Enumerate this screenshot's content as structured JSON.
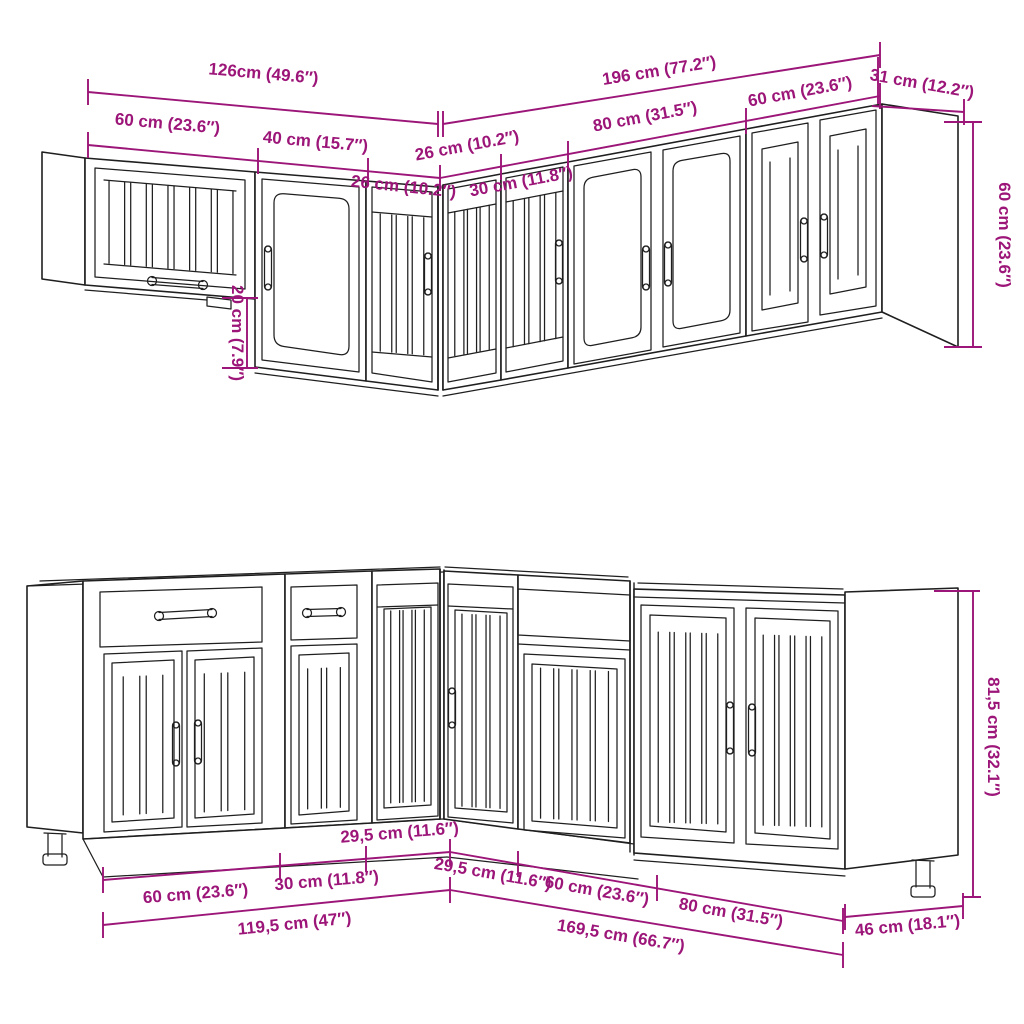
{
  "figure": {
    "kind": "furniture-dimension-line-art",
    "rows": [
      "wall-cabinets",
      "base-cabinets"
    ]
  },
  "colors": {
    "dimension": "#9C1578",
    "artwork": "#1F1F1F",
    "background": "#FFFFFF"
  },
  "labels": {
    "top_total_left": "126cm (49.6″)",
    "top_total_right": "196 cm (77.2″)",
    "top_depth_right": "31 cm (12.2″)",
    "top_seg_60_left": "60 cm (23.6″)",
    "top_seg_40": "40 cm (15.7″)",
    "top_seg_26_left": "26 cm (10.2″)",
    "top_seg_26_right": "26 cm (10.2″)",
    "top_seg_30": "30 cm (11.8″)",
    "top_seg_80": "80 cm (31.5″)",
    "top_seg_60_right": "60 cm (23.6″)",
    "top_height_offset": "20 cm (7.9″)",
    "top_height_right": "60 cm (23.6″)",
    "bottom_seg_29_left": "29,5 cm (11.6″)",
    "bottom_seg_60_left": "60 cm (23.6″)",
    "bottom_seg_30": "30 cm (11.8″)",
    "bottom_seg_29_right": "29,5 cm (11.6″)",
    "bottom_seg_60_right": "60 cm (23.6″)",
    "bottom_seg_80": "80 cm (31.5″)",
    "bottom_total_left": "119,5 cm (47″)",
    "bottom_total_right": "169,5 cm (66.7″)",
    "bottom_depth_right": "46 cm (18.1″)",
    "bottom_height_right": "81,5 cm (32.1″)"
  }
}
